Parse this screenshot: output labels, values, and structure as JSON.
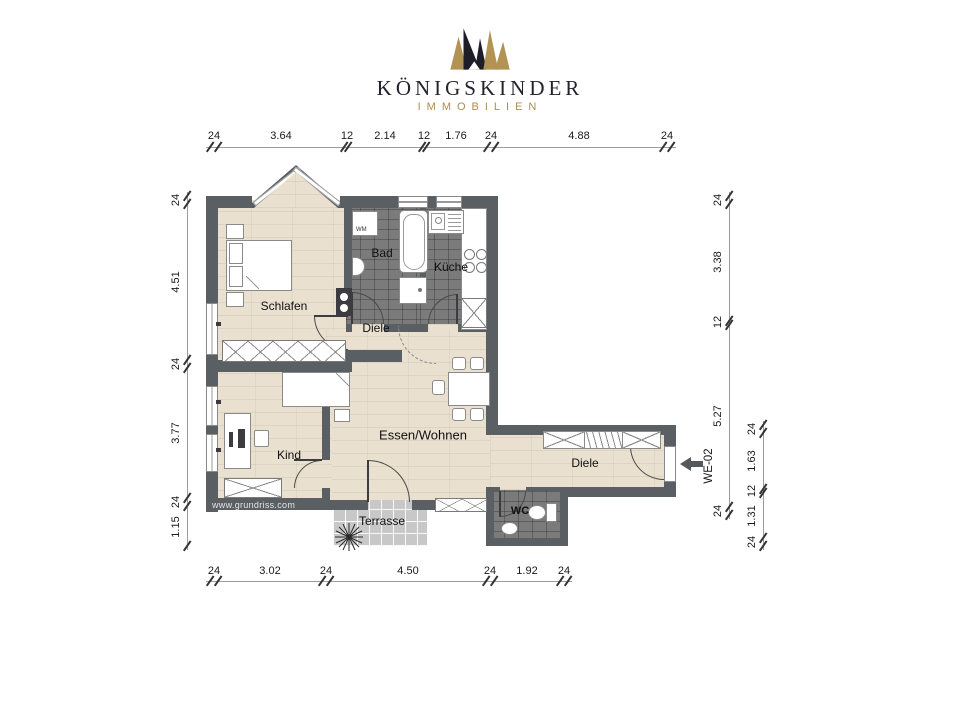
{
  "brand": {
    "name": "KÖNIGSKINDER",
    "subtitle": "IMMOBILIEN"
  },
  "watermark": "www.grundriss.com",
  "unit": {
    "label": "WE-02"
  },
  "rooms": {
    "schlafen": "Schlafen",
    "bad": "Bad",
    "kueche": "Küche",
    "diele_mitte": "Diele",
    "kind": "Kind",
    "essen_wohnen": "Essen/Wohnen",
    "diele_flur": "Diele",
    "wc": "WC",
    "terrasse": "Terrasse"
  },
  "appliances": {
    "wm": "WM"
  },
  "dims": {
    "top": [
      "24",
      "3.64",
      "12",
      "2.14",
      "12",
      "1.76",
      "24",
      "4.88",
      "24"
    ],
    "bottom": [
      "24",
      "3.02",
      "24",
      "4.50",
      "24",
      "1.92",
      "24"
    ],
    "left": [
      "24",
      "4.51",
      "24",
      "3.77",
      "24",
      "1.15"
    ],
    "right_inner": [
      "24",
      "3.38",
      "12",
      "5.27",
      "24"
    ],
    "right_outer": [
      "24",
      "1.63",
      "12",
      "1.31",
      "24"
    ]
  },
  "colors": {
    "wall": "#5a5f64",
    "gold": "#ad8d52",
    "dark": "#23232d",
    "wood": "#e9e0cf",
    "tile": "#7b7b7b",
    "terrace": "#c8c8c8"
  }
}
